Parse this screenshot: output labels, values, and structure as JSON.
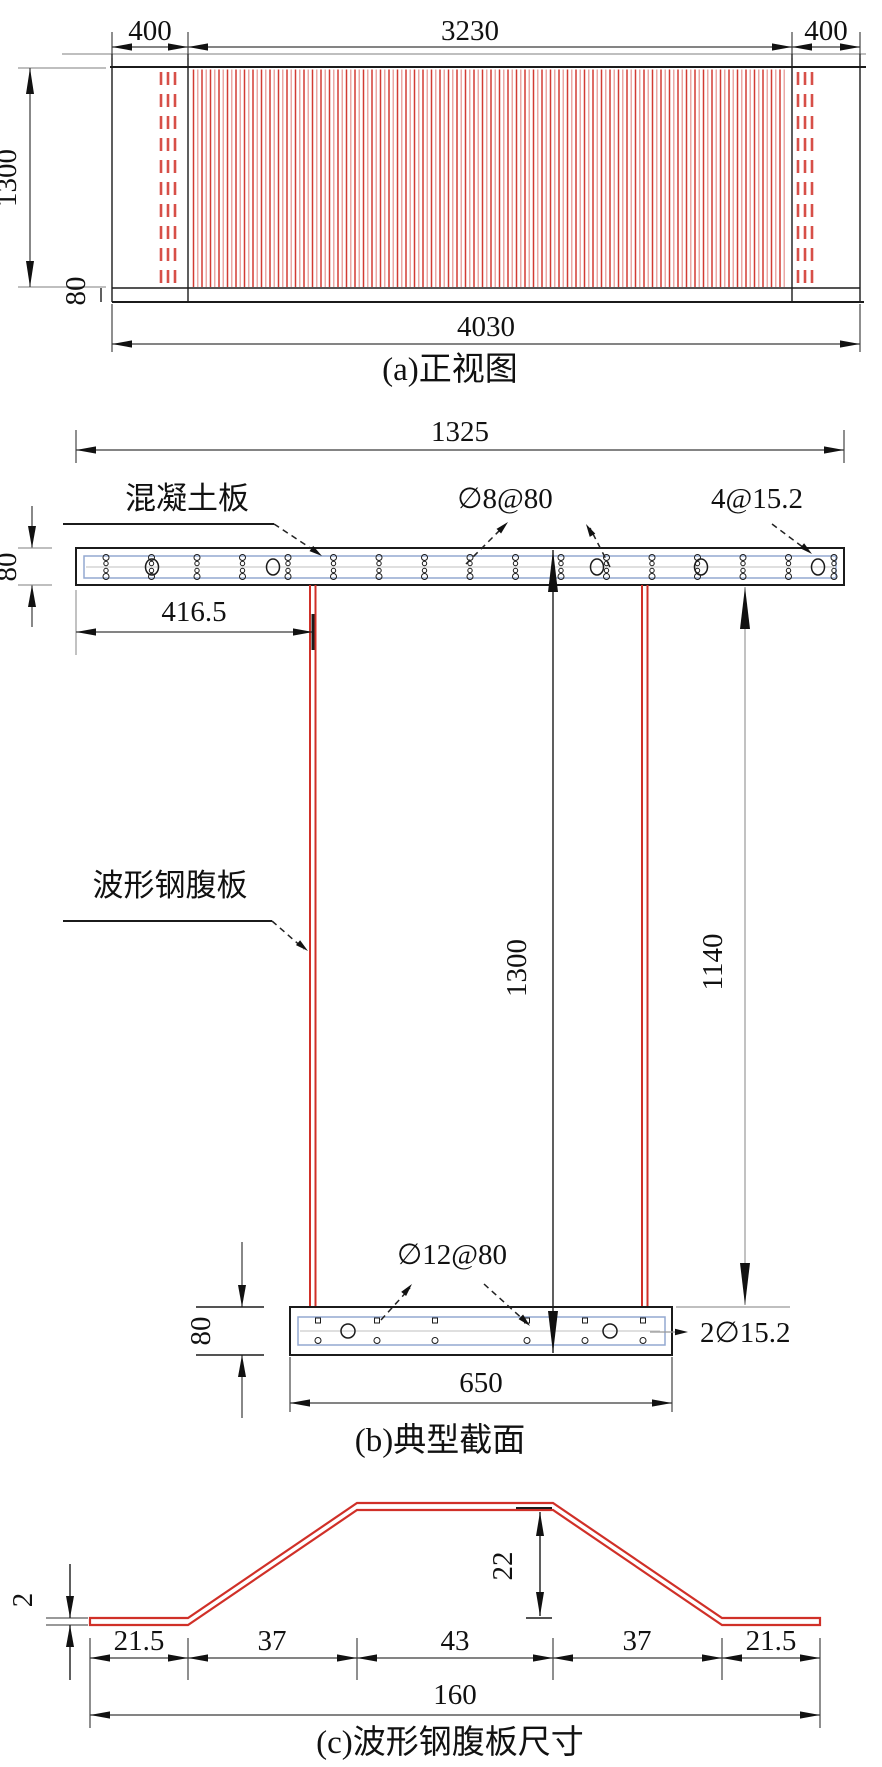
{
  "panel_a": {
    "caption": "(a)正视图",
    "dim_overhang_left": "400",
    "dim_span": "3230",
    "dim_overhang_right": "400",
    "dim_height": "1300",
    "dim_flange": "80",
    "dim_total_length": "4030"
  },
  "panel_b": {
    "caption": "(b)典型截面",
    "dim_slab_width": "1325",
    "dim_slab_thickness": "80",
    "dim_web_offset": "416.5",
    "dim_total_height": "1300",
    "dim_web_height": "1140",
    "dim_flange_thickness": "80",
    "dim_flange_width": "650",
    "label_concrete_slab": "混凝土板",
    "label_top_rebar": "∅8@80",
    "label_top_strands": "4@15.2",
    "label_corrugated_web": "波形钢腹板",
    "label_bottom_rebar": "∅12@80",
    "label_bottom_strands": "2∅15.2"
  },
  "panel_c": {
    "caption": "(c)波形钢腹板尺寸",
    "dim_wave_height": "22",
    "dim_plate_thickness": "2",
    "dim_segments": [
      "21.5",
      "37",
      "43",
      "37",
      "21.5"
    ],
    "dim_total_width": "160"
  },
  "colors": {
    "web_red": "#d03028",
    "rebar_blue": "#93a9d1",
    "line_black": "#1b1b1b",
    "dim_gray": "#999999"
  }
}
